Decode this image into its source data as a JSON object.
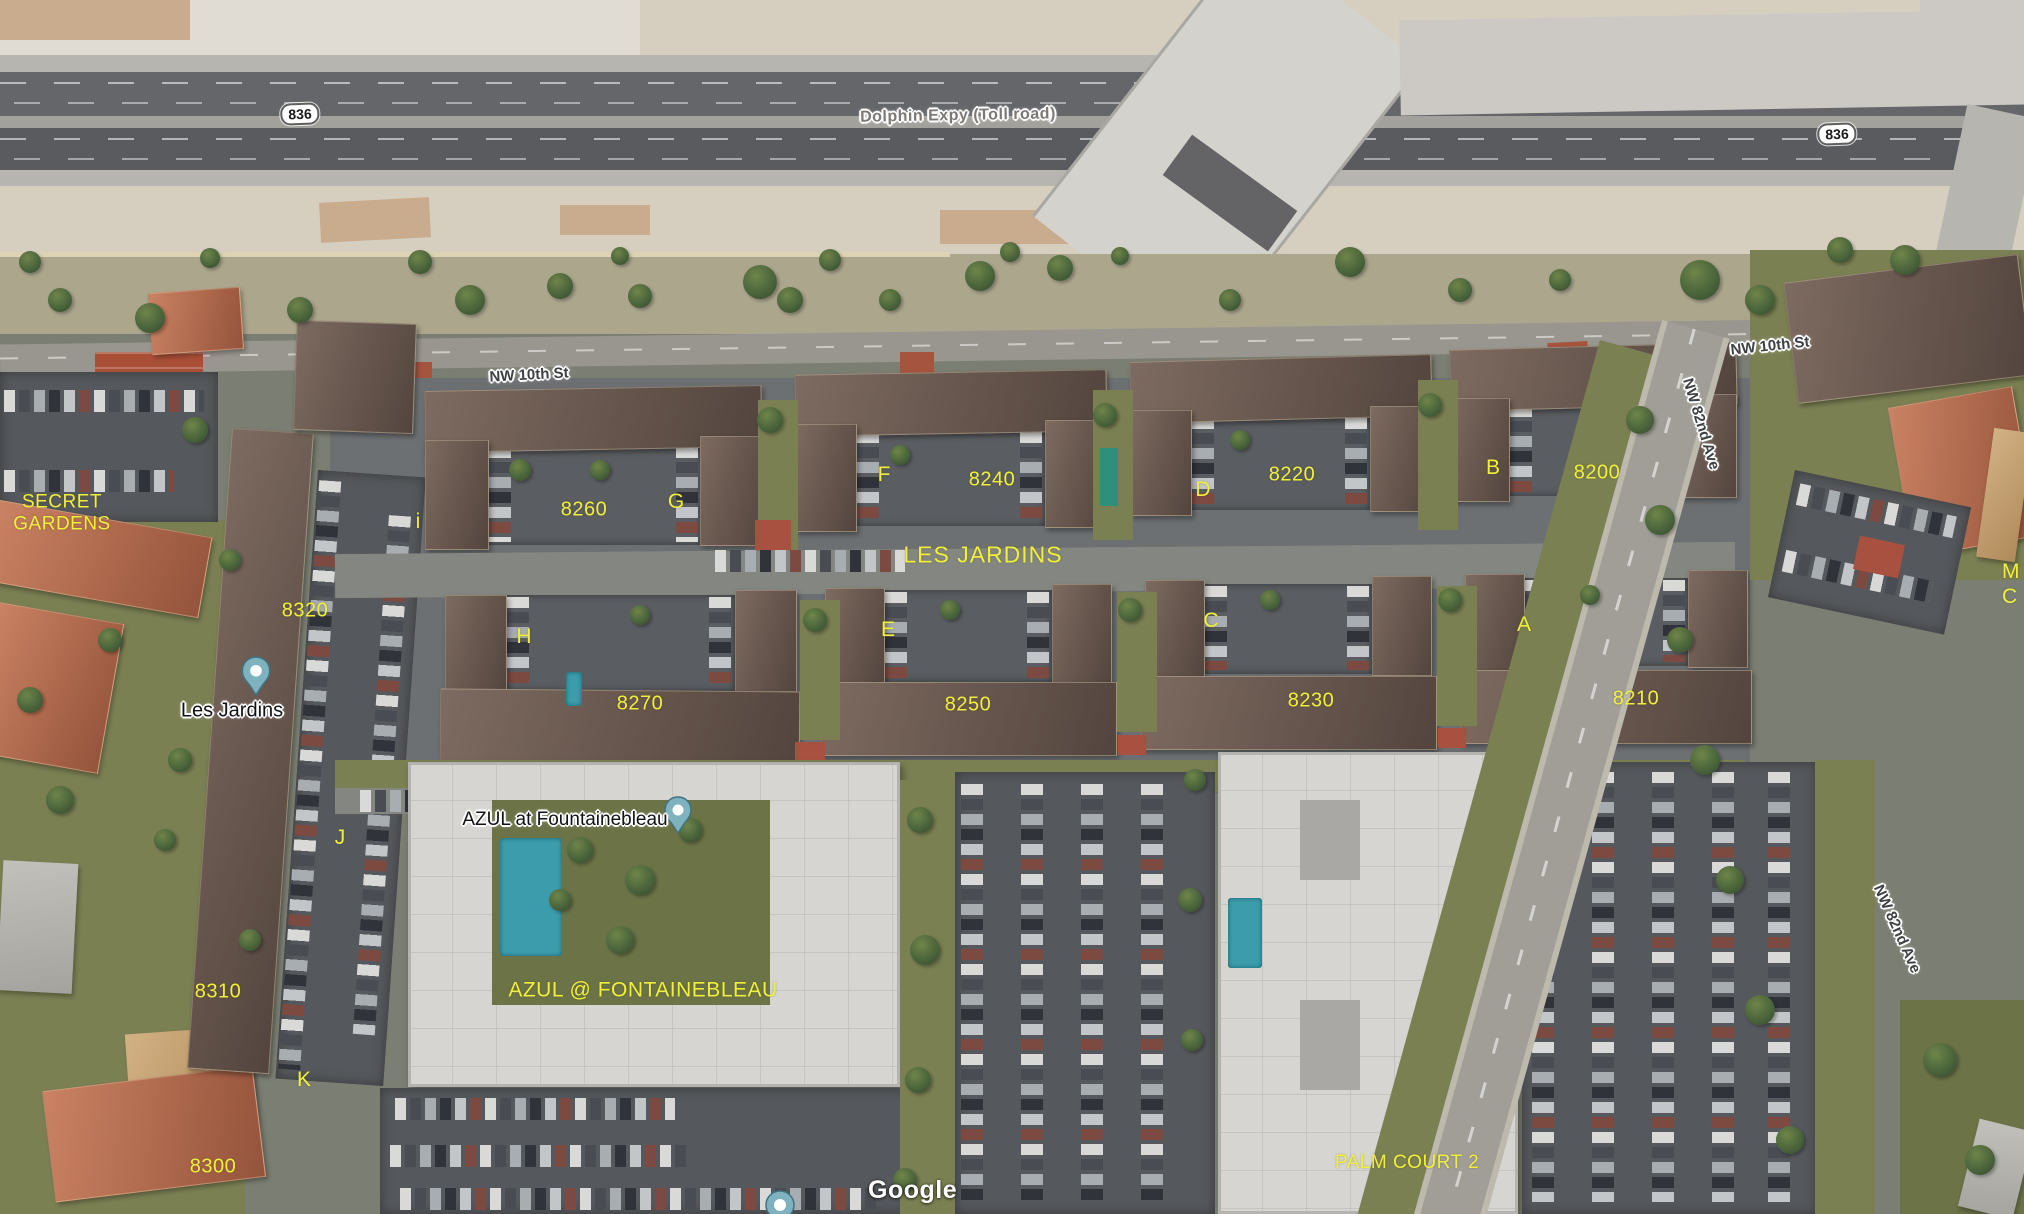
{
  "attribution": "Google",
  "roads": {
    "dolphin_expy": "Dolphin Expy (Toll road)",
    "nw_10th_left": "NW 10th St",
    "nw_10th_right": "NW 10th St",
    "nw_82nd_top": "NW 82nd Ave",
    "nw_82nd_bottom": "NW 82nd Ave",
    "shield_left": "836",
    "shield_right": "836"
  },
  "markers": {
    "les_jardins": "Les Jardins",
    "azul": "AZUL at Fountainebleau"
  },
  "complex_labels": {
    "secret_gardens": "SECRET\nGARDENS",
    "les_jardins": "LES JARDINS",
    "azul": "AZUL @ FONTAINEBLEAU",
    "palm_court": "PALM COURT 2",
    "edge_partial": "M\nC"
  },
  "building_letters": [
    "i",
    "G",
    "F",
    "D",
    "B",
    "H",
    "E",
    "C",
    "A",
    "J",
    "K"
  ],
  "addresses": [
    "8260",
    "8240",
    "8220",
    "8200",
    "8320",
    "8270",
    "8250",
    "8230",
    "8210",
    "8310",
    "8300"
  ],
  "colors": {
    "annotation_yellow": "#f1ef3d",
    "pin_fill": "#7fb2bf",
    "pool_teal": "#3d9cab"
  }
}
